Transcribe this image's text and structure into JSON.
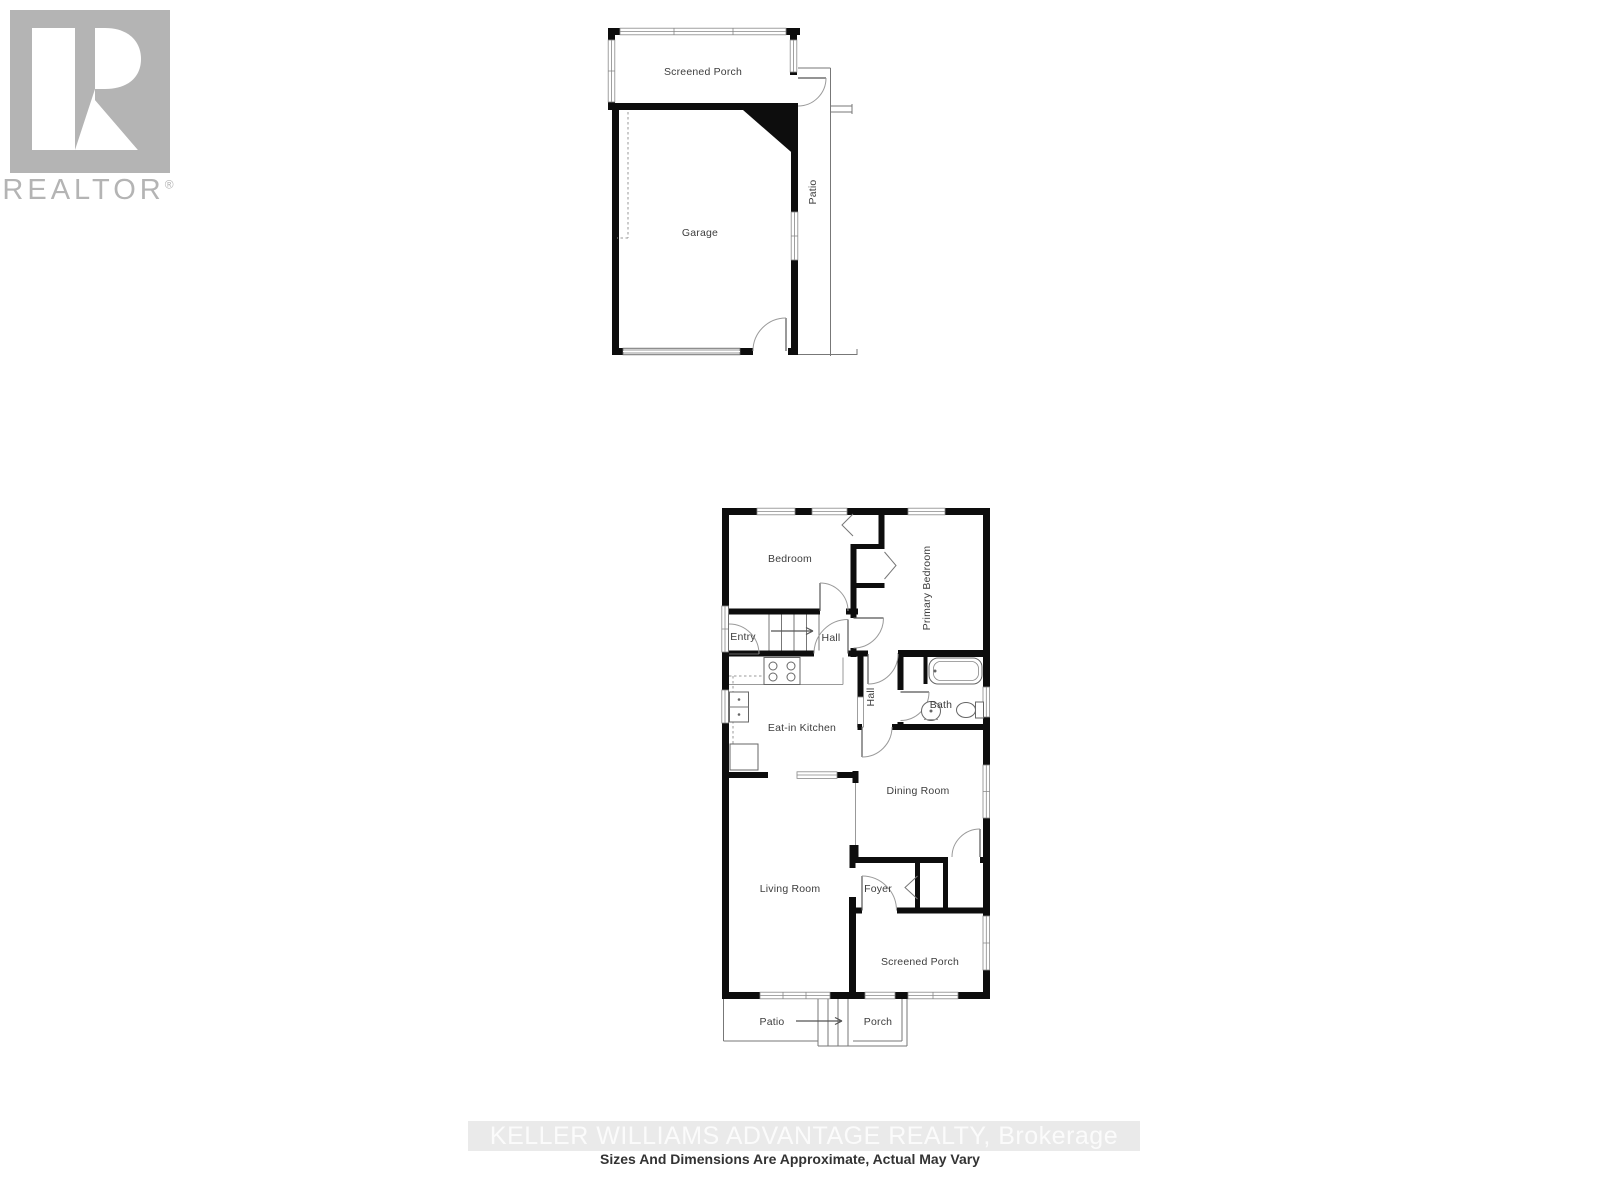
{
  "logo": {
    "brand": "REALTOR",
    "registered": "®"
  },
  "garage_plan": {
    "screened_porch": "Screened Porch",
    "garage": "Garage",
    "patio": "Patio"
  },
  "main_plan": {
    "bedroom": "Bedroom",
    "primary_bedroom": "Primary Bedroom",
    "entry": "Entry",
    "hall_upper": "Hall",
    "eat_in_kitchen": "Eat-in Kitchen",
    "hall_lower": "Hall",
    "bath": "Bath",
    "dining_room": "Dining Room",
    "living_room": "Living Room",
    "foyer": "Foyer",
    "screened_porch": "Screened Porch",
    "patio": "Patio",
    "porch": "Porch"
  },
  "footer": {
    "watermark": "KELLER WILLIAMS ADVANTAGE REALTY, Brokerage",
    "disclaimer": "Sizes And Dimensions Are Approximate, Actual May Vary"
  },
  "colors": {
    "wall": "#0d0d0d",
    "thin_line": "#777777",
    "label_text": "#3d3d3d",
    "logo_gray": "#b4b4b4",
    "watermark_bg": "#eaeaea",
    "watermark_text": "#fbfbfb",
    "garage_door": "#cccccc"
  }
}
